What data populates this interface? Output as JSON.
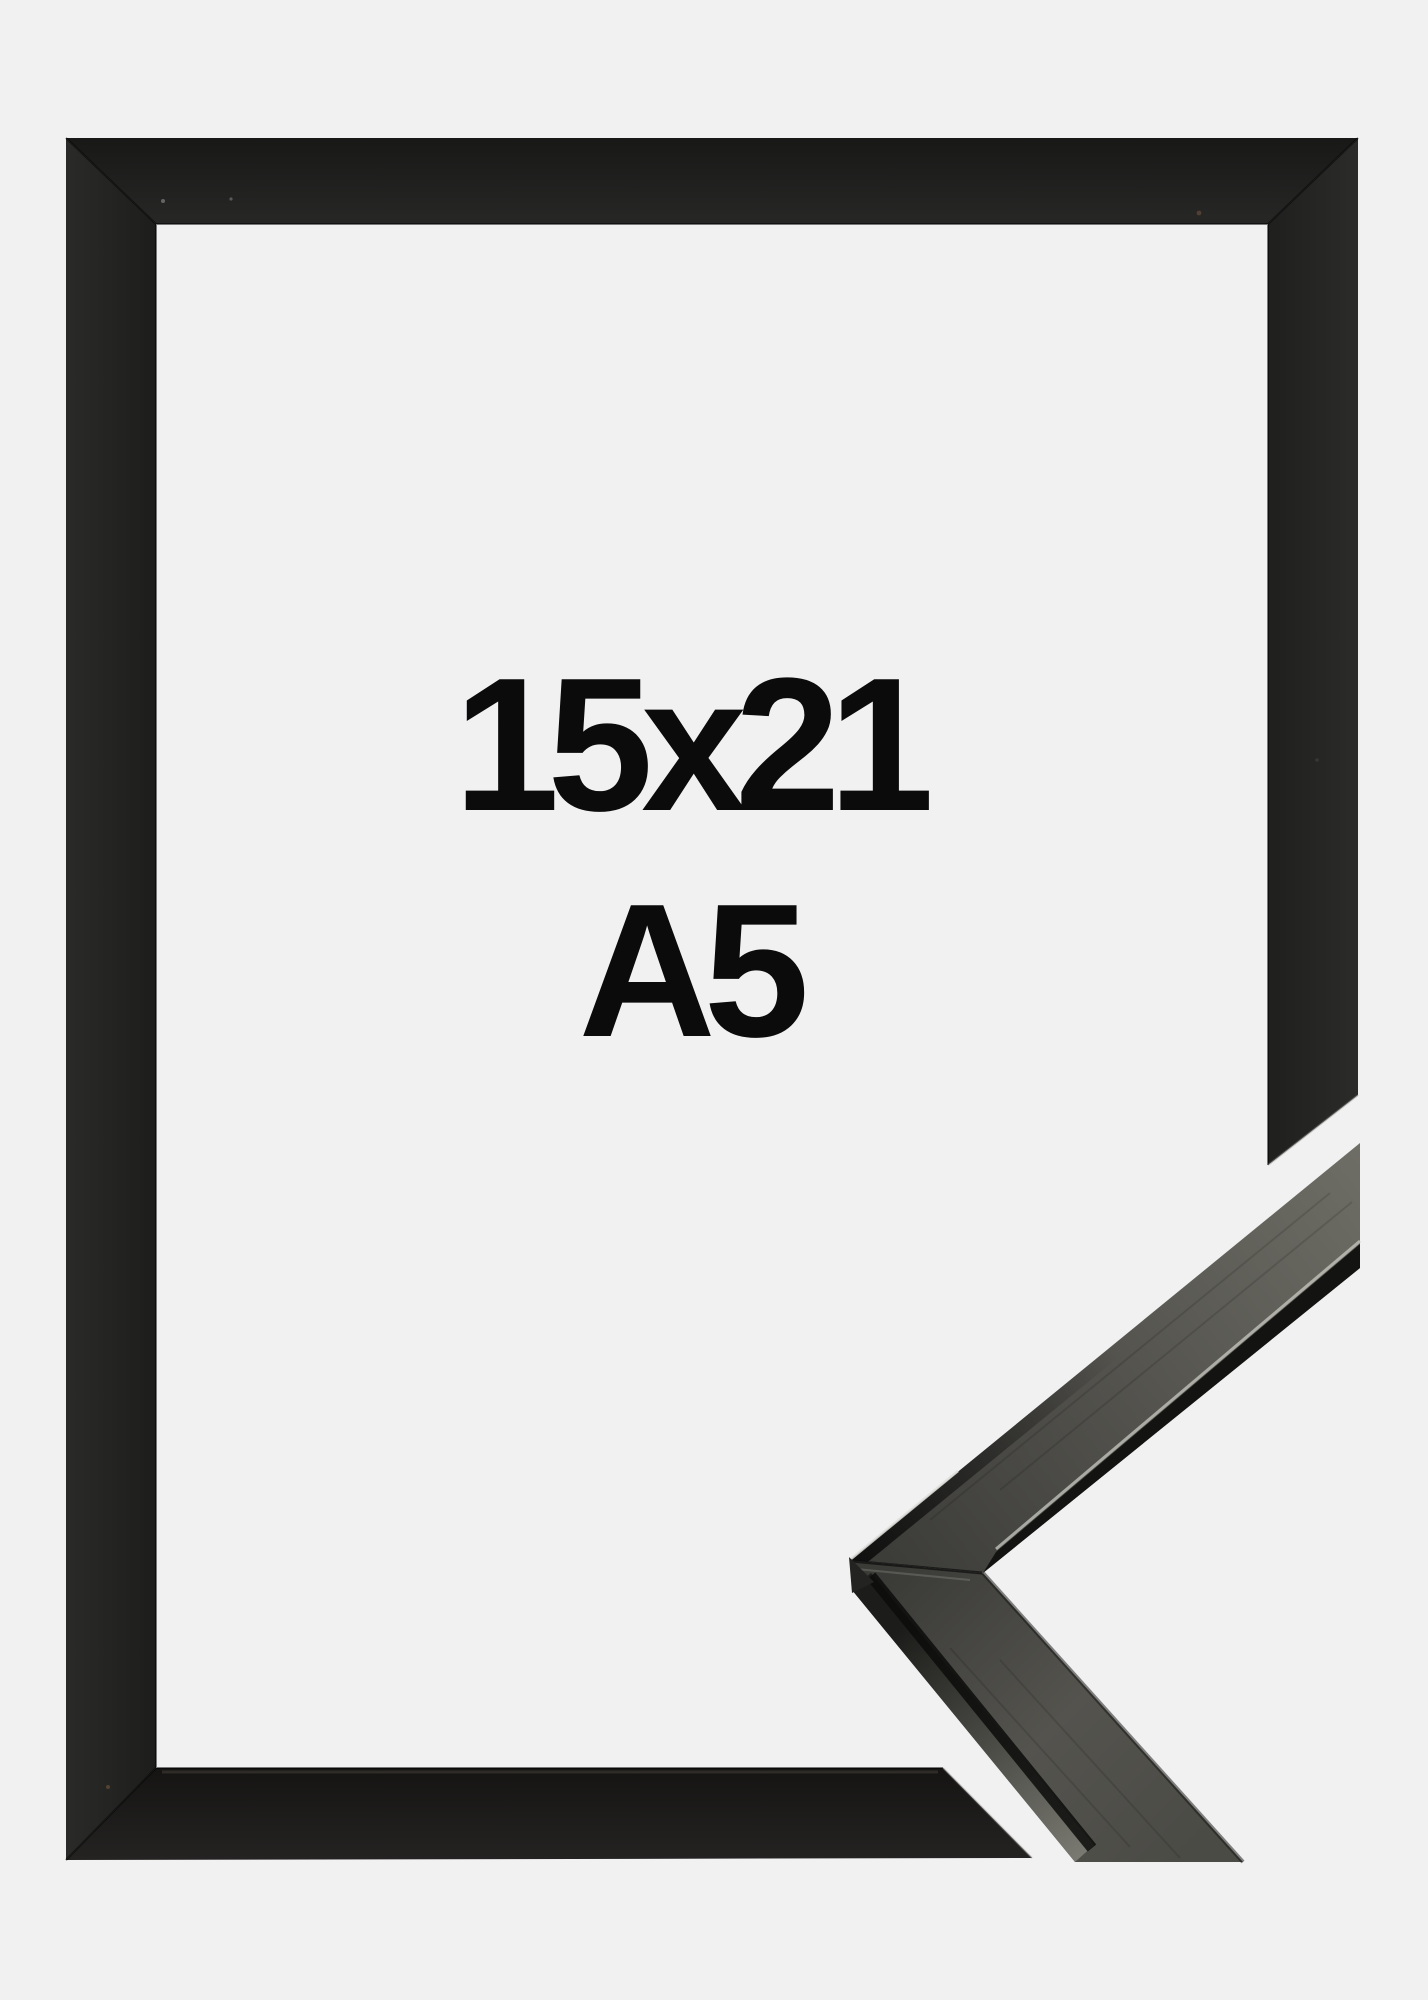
{
  "size_label": {
    "line1": "15x21",
    "line2": "A5"
  },
  "colors": {
    "background": "#f1f1f2",
    "frame_black": "#1e1e1d",
    "label_text": "#0b0b0b",
    "moulding_face_dark": "#3a3a37",
    "moulding_face_mid": "#54534e",
    "moulding_face_light": "#6e6e66",
    "moulding_side_shadow": "#131312",
    "moulding_side_lit": "#7b7b73",
    "moulding_edge_highlight": "#c9c9c3"
  }
}
